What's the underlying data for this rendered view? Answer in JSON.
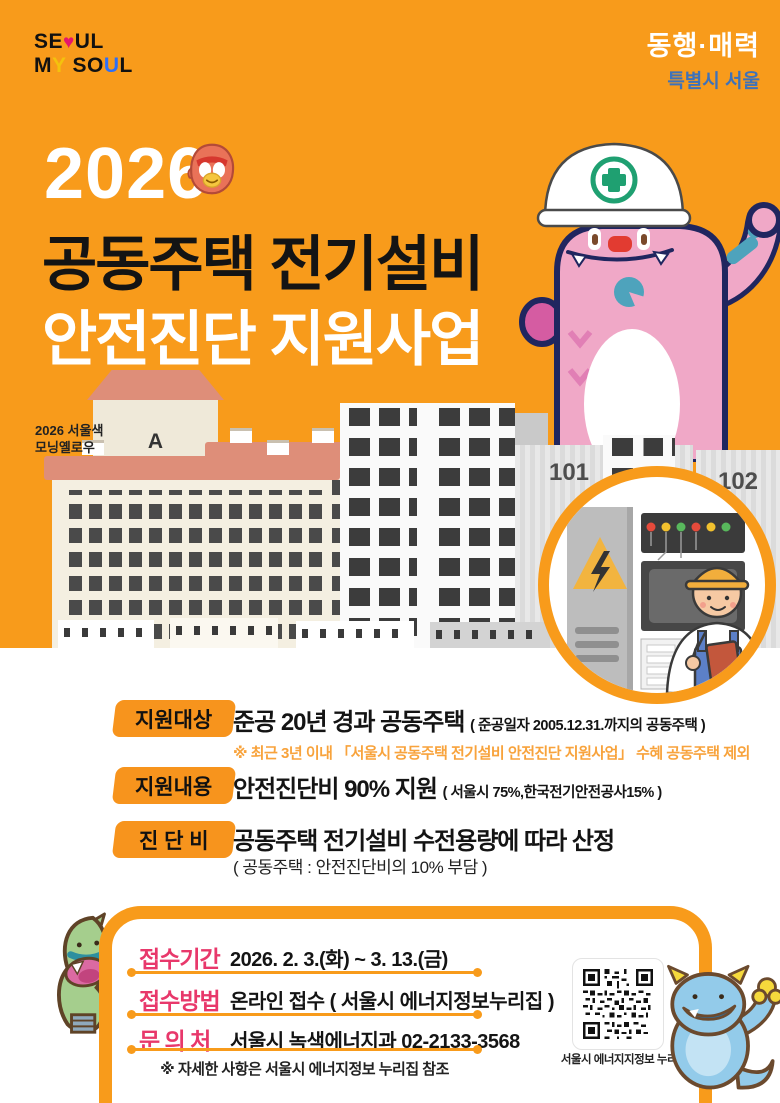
{
  "brand": {
    "seoul_a": "SE",
    "seoul_heart": "♥",
    "seoul_b": "UL",
    "my_m": "M",
    "my_y": "Y",
    "soul_a": "SO",
    "soul_u": "U",
    "soul_l": "L"
  },
  "slogan": {
    "line1": "동행·매력",
    "line2": "특별시 서울"
  },
  "title": {
    "year": "2026",
    "line1": "공동주택 전기설비",
    "line2": "안전진단 지원사업"
  },
  "color_note": {
    "line1": "2026 서울색",
    "line2": "모닝옐로우"
  },
  "buildings": {
    "a_letter": "A",
    "a_number": "101",
    "b101": "101",
    "b102": "102"
  },
  "info_rows": [
    {
      "badge": "지원대상",
      "main": "준공 20년 경과 공동주택",
      "paren": "( 준공일자 2005.12.31.까지의 공동주택 )",
      "note": "※ 최근 3년 이내 「서울시 공동주택 전기설비 안전진단 지원사업」 수혜 공동주택 제외"
    },
    {
      "badge": "지원내용",
      "main": "안전진단비 90% 지원",
      "paren": "( 서울시 75%,한국전기안전공사15% )"
    },
    {
      "badge": "진 단 비",
      "main": "공동주택 전기설비 수전용량에 따라 산정",
      "paren": "( 공동주택 : 안전진단비의 10% 부담 )"
    }
  ],
  "apply": {
    "rows": [
      {
        "label": "접수기간",
        "value": "2026. 2. 3.(화) ~ 3. 13.(금)"
      },
      {
        "label": "접수방법",
        "value": "온라인 접수 ( 서울시 에너지정보누리집 )"
      },
      {
        "label": "문 의 처",
        "value": "서울시 녹색에너지과 02-2133-3568"
      }
    ],
    "note": "※ 자세한 사항은 서울시 에너지정보 누리집 참조",
    "qr_label": "서울시 에너지지정보 누리집"
  },
  "colors": {
    "background_orange": "#F89B1B",
    "badge_orange": "#F7941D",
    "label_pink": "#E8386B",
    "title_black": "#141414",
    "slogan_blue": "#3E72B9",
    "note_orange": "#F8A33C",
    "monster_pink": "#F0A8C7",
    "helmet_green": "#1FA071"
  }
}
